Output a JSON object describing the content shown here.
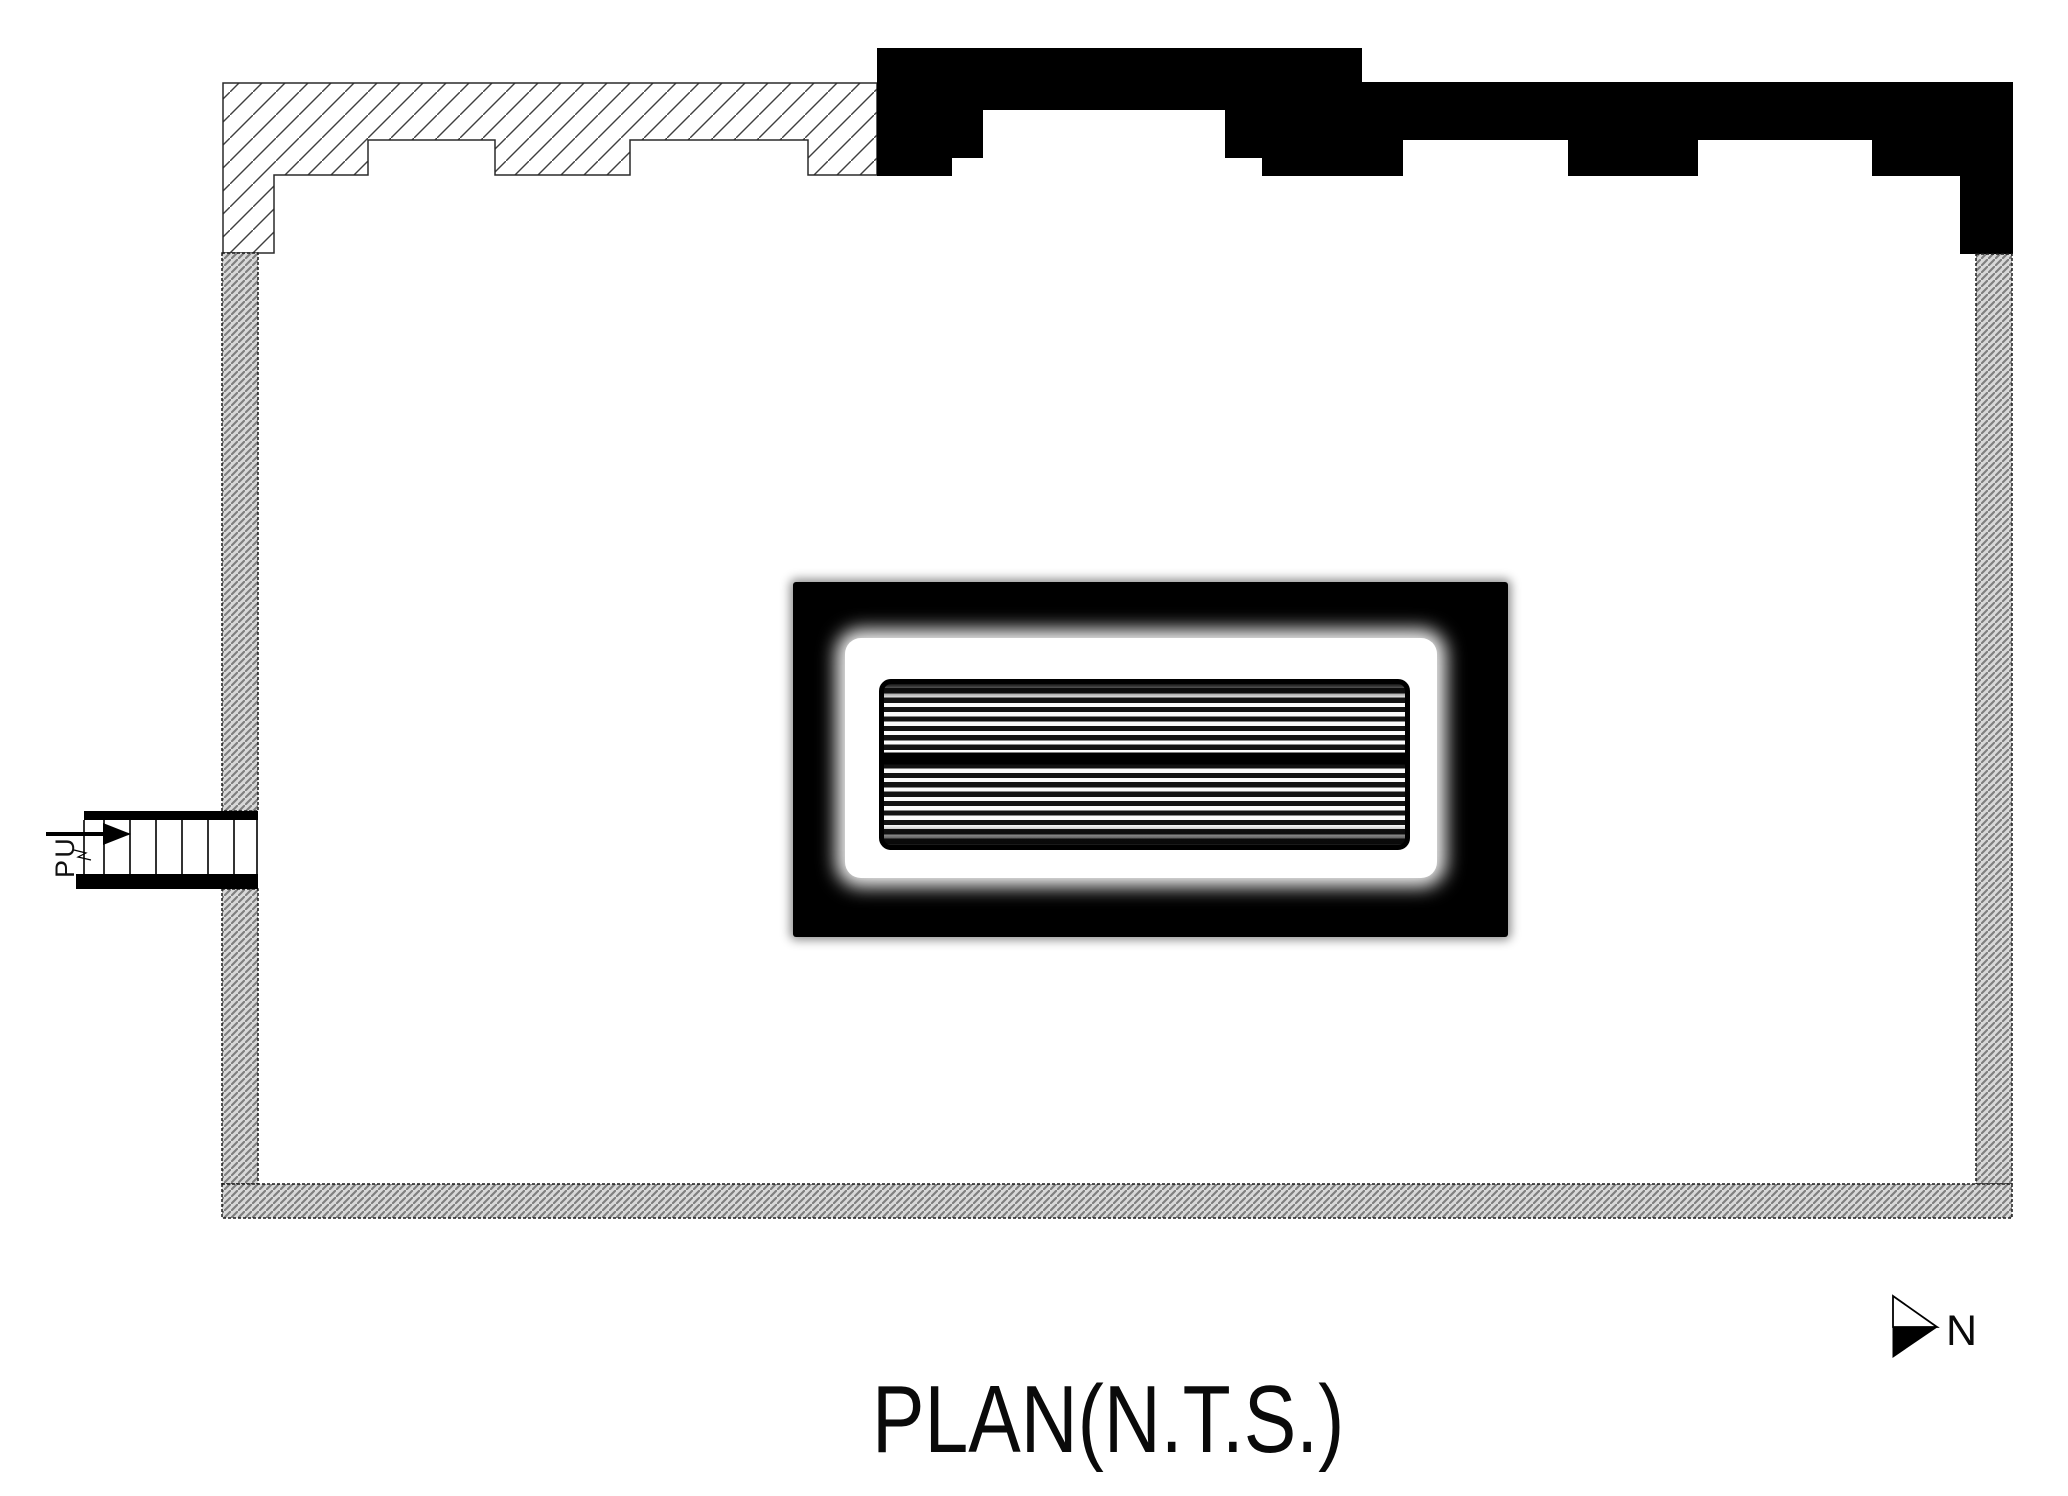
{
  "drawing": {
    "title": "PLAN(N.T.S.)",
    "stair": {
      "label": "UP"
    },
    "north_indicator": {
      "label": "N"
    },
    "colors": {
      "paper": "#ffffff",
      "solid_wall_fill": "#000000",
      "hatch_line": "#3f3f3f",
      "gray_wall_fill": "#d8d8d8",
      "gray_wall_line": "#7f7f7f"
    },
    "icons": {
      "north_arrow": "north-arrow-icon",
      "stair_direction_arrow": "up-direction-arrow-icon"
    }
  }
}
